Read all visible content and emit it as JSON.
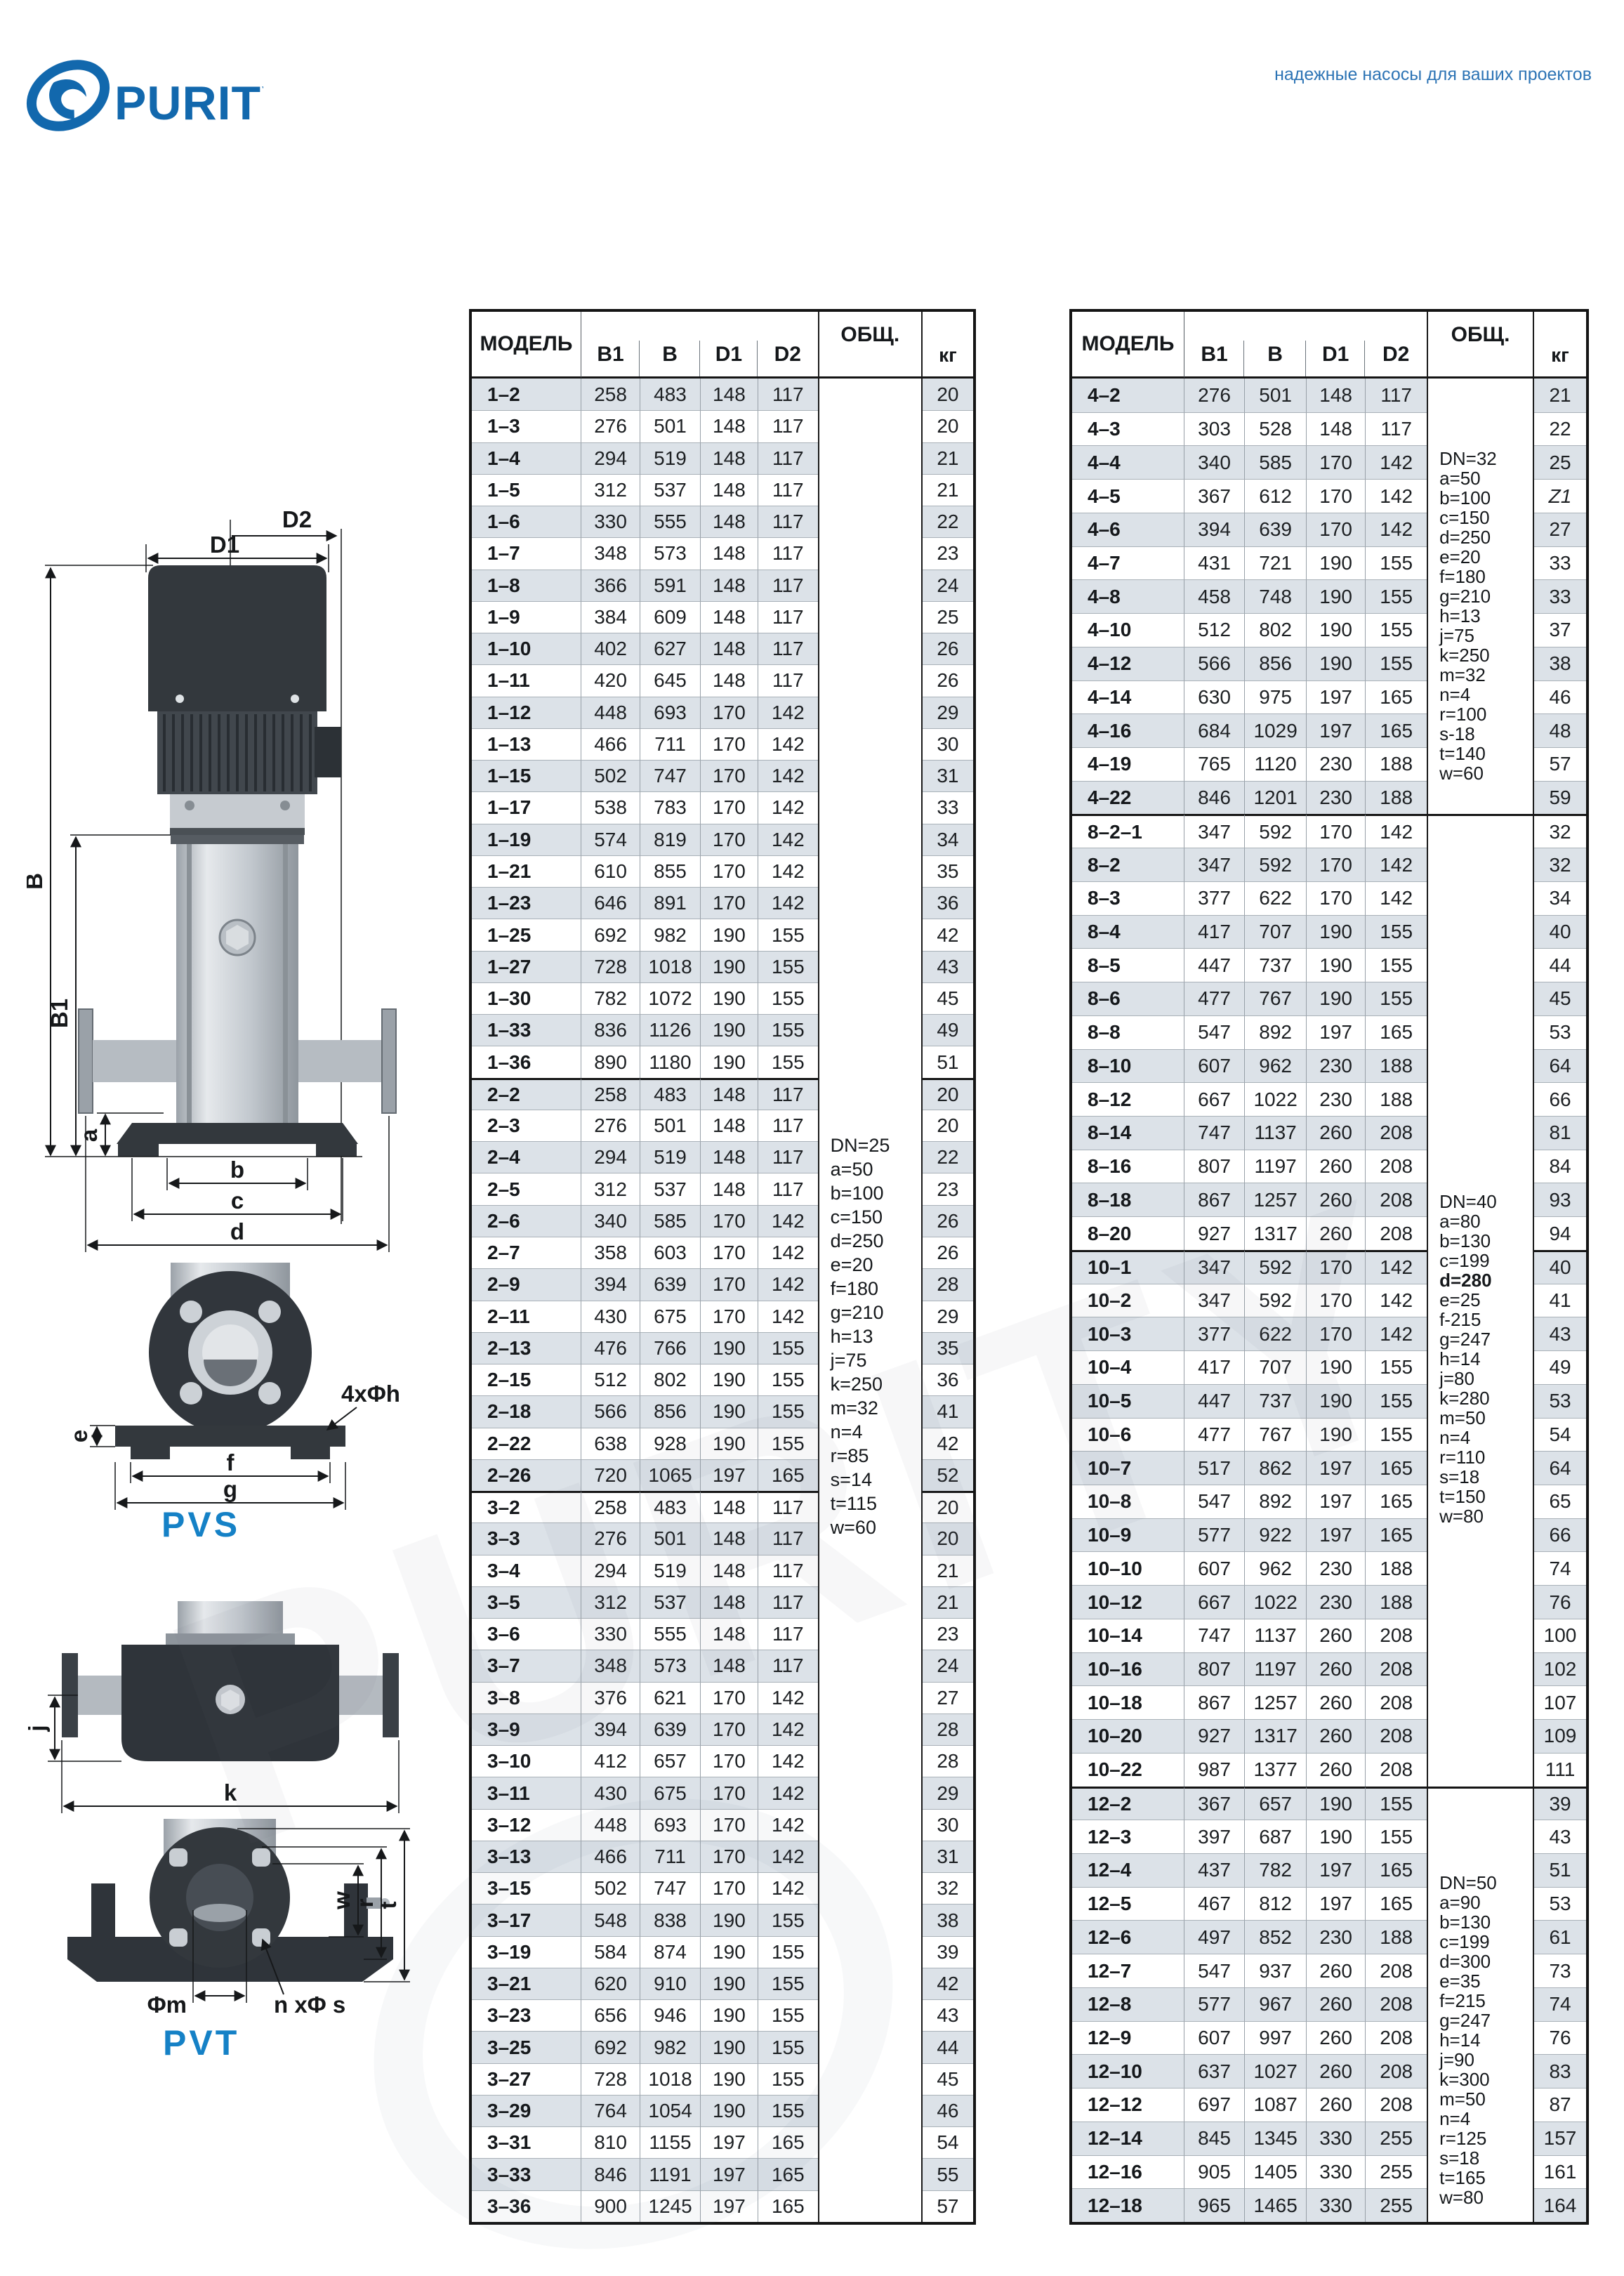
{
  "brand": {
    "wordmark": "PURITY",
    "tagline": "надежные насосы для ваших проектов",
    "accent": "#1268ad",
    "label_blue": "#1581c6",
    "stripe": "#dce2e8"
  },
  "drawings": {
    "pvs_label": "PVS",
    "pvt_label": "PVT",
    "side": {
      "d2": "D2",
      "d1": "D1",
      "b": "B",
      "b1": "B1",
      "a": "a",
      "dim_b": "b",
      "dim_c": "c",
      "dim_d": "d"
    },
    "front": {
      "holes": "4xΦh",
      "e": "e",
      "f": "f",
      "g": "g"
    },
    "inline": {
      "j": "j",
      "k": "k"
    },
    "section": {
      "w": "w",
      "r": "r",
      "t": "t",
      "phi_m": "Φm",
      "n_phi_s": "n xΦ s"
    }
  },
  "tables": {
    "headers": {
      "model": "МОДЕЛЬ",
      "cols": [
        "B1",
        "B",
        "D1",
        "D2"
      ],
      "notes": "ОБЩ.",
      "weight": "кг"
    },
    "left": {
      "groups": [
        {
          "rows": [
            [
              "1–2",
              258,
              483,
              148,
              117,
              20
            ],
            [
              "1–3",
              276,
              501,
              148,
              117,
              20
            ],
            [
              "1–4",
              294,
              519,
              148,
              117,
              21
            ],
            [
              "1–5",
              312,
              537,
              148,
              117,
              21
            ],
            [
              "1–6",
              330,
              555,
              148,
              117,
              22
            ],
            [
              "1–7",
              348,
              573,
              148,
              117,
              23
            ],
            [
              "1–8",
              366,
              591,
              148,
              117,
              24
            ],
            [
              "1–9",
              384,
              609,
              148,
              117,
              25
            ],
            [
              "1–10",
              402,
              627,
              148,
              117,
              26
            ],
            [
              "1–11",
              420,
              645,
              148,
              117,
              26
            ],
            [
              "1–12",
              448,
              693,
              170,
              142,
              29
            ],
            [
              "1–13",
              466,
              711,
              170,
              142,
              30
            ],
            [
              "1–15",
              502,
              747,
              170,
              142,
              31
            ],
            [
              "1–17",
              538,
              783,
              170,
              142,
              33
            ],
            [
              "1–19",
              574,
              819,
              170,
              142,
              34
            ],
            [
              "1–21",
              610,
              855,
              170,
              142,
              35
            ],
            [
              "1–23",
              646,
              891,
              170,
              142,
              36
            ],
            [
              "1–25",
              692,
              982,
              190,
              155,
              42
            ],
            [
              "1–27",
              728,
              1018,
              190,
              155,
              43
            ],
            [
              "1–30",
              782,
              1072,
              190,
              155,
              45
            ],
            [
              "1–33",
              836,
              1126,
              190,
              155,
              49
            ],
            [
              "1–36",
              890,
              1180,
              190,
              155,
              51
            ]
          ]
        },
        {
          "rows": [
            [
              "2–2",
              258,
              483,
              148,
              117,
              20
            ],
            [
              "2–3",
              276,
              501,
              148,
              117,
              20
            ],
            [
              "2–4",
              294,
              519,
              148,
              117,
              22
            ],
            [
              "2–5",
              312,
              537,
              148,
              117,
              23
            ],
            [
              "2–6",
              340,
              585,
              170,
              142,
              26
            ],
            [
              "2–7",
              358,
              603,
              170,
              142,
              26
            ],
            [
              "2–9",
              394,
              639,
              170,
              142,
              28
            ],
            [
              "2–11",
              430,
              675,
              170,
              142,
              29
            ],
            [
              "2–13",
              476,
              766,
              190,
              155,
              35
            ],
            [
              "2–15",
              512,
              802,
              190,
              155,
              36
            ],
            [
              "2–18",
              566,
              856,
              190,
              155,
              41
            ],
            [
              "2–22",
              638,
              928,
              190,
              155,
              42
            ],
            [
              "2–26",
              720,
              1065,
              197,
              165,
              52
            ]
          ]
        },
        {
          "rows": [
            [
              "3–2",
              258,
              483,
              148,
              117,
              20
            ],
            [
              "3–3",
              276,
              501,
              148,
              117,
              20
            ],
            [
              "3–4",
              294,
              519,
              148,
              117,
              21
            ],
            [
              "3–5",
              312,
              537,
              148,
              117,
              21
            ],
            [
              "3–6",
              330,
              555,
              148,
              117,
              23
            ],
            [
              "3–7",
              348,
              573,
              148,
              117,
              24
            ],
            [
              "3–8",
              376,
              621,
              170,
              142,
              27
            ],
            [
              "3–9",
              394,
              639,
              170,
              142,
              28
            ],
            [
              "3–10",
              412,
              657,
              170,
              142,
              28
            ],
            [
              "3–11",
              430,
              675,
              170,
              142,
              29
            ],
            [
              "3–12",
              448,
              693,
              170,
              142,
              30
            ],
            [
              "3–13",
              466,
              711,
              170,
              142,
              31
            ],
            [
              "3–15",
              502,
              747,
              170,
              142,
              32
            ],
            [
              "3–17",
              548,
              838,
              190,
              155,
              38
            ],
            [
              "3–19",
              584,
              874,
              190,
              155,
              39
            ],
            [
              "3–21",
              620,
              910,
              190,
              155,
              42
            ],
            [
              "3–23",
              656,
              946,
              190,
              155,
              43
            ],
            [
              "3–25",
              692,
              982,
              190,
              155,
              44
            ],
            [
              "3–27",
              728,
              1018,
              190,
              155,
              45
            ],
            [
              "3–29",
              764,
              1054,
              190,
              155,
              46
            ],
            [
              "3–31",
              810,
              1155,
              197,
              165,
              54
            ],
            [
              "3–33",
              846,
              1191,
              197,
              165,
              55
            ],
            [
              "3–36",
              900,
              1245,
              197,
              165,
              57
            ]
          ]
        }
      ],
      "notes": [
        {
          "start": 0,
          "span": 58,
          "cls": "noff-l",
          "bold": [],
          "lines": [
            "DN=25",
            "a=50",
            "b=100",
            "c=150",
            "d=250",
            "e=20",
            "f=180",
            "g=210",
            "h=13",
            "j=75",
            "k=250",
            "m=32",
            "n=4",
            "r=85",
            "s=14",
            "t=115",
            "w=60"
          ]
        }
      ]
    },
    "right": {
      "groups": [
        {
          "rows": [
            [
              "4–2",
              276,
              501,
              148,
              117,
              21
            ],
            [
              "4–3",
              303,
              528,
              148,
              117,
              22
            ],
            [
              "4–4",
              340,
              585,
              170,
              142,
              25
            ],
            [
              "4–5",
              367,
              612,
              170,
              142,
              "Z1"
            ],
            [
              "4–6",
              394,
              639,
              170,
              142,
              27
            ],
            [
              "4–7",
              431,
              721,
              190,
              155,
              33
            ],
            [
              "4–8",
              458,
              748,
              190,
              155,
              33
            ],
            [
              "4–10",
              512,
              802,
              190,
              155,
              37
            ],
            [
              "4–12",
              566,
              856,
              190,
              155,
              38
            ],
            [
              "4–14",
              630,
              975,
              197,
              165,
              46
            ],
            [
              "4–16",
              684,
              1029,
              197,
              165,
              48
            ],
            [
              "4–19",
              765,
              1120,
              230,
              188,
              57
            ],
            [
              "4–22",
              846,
              1201,
              230,
              188,
              59
            ]
          ]
        },
        {
          "rows": [
            [
              "8–2–1",
              347,
              592,
              170,
              142,
              32
            ],
            [
              "8–2",
              347,
              592,
              170,
              142,
              32
            ],
            [
              "8–3",
              377,
              622,
              170,
              142,
              34
            ],
            [
              "8–4",
              417,
              707,
              190,
              155,
              40
            ],
            [
              "8–5",
              447,
              737,
              190,
              155,
              44
            ],
            [
              "8–6",
              477,
              767,
              190,
              155,
              45
            ],
            [
              "8–8",
              547,
              892,
              197,
              165,
              53
            ],
            [
              "8–10",
              607,
              962,
              230,
              188,
              64
            ],
            [
              "8–12",
              667,
              1022,
              230,
              188,
              66
            ],
            [
              "8–14",
              747,
              1137,
              260,
              208,
              81
            ],
            [
              "8–16",
              807,
              1197,
              260,
              208,
              84
            ],
            [
              "8–18",
              867,
              1257,
              260,
              208,
              93
            ],
            [
              "8–20",
              927,
              1317,
              260,
              208,
              94
            ]
          ]
        },
        {
          "rows": [
            [
              "10–1",
              347,
              592,
              170,
              142,
              40
            ],
            [
              "10–2",
              347,
              592,
              170,
              142,
              41
            ],
            [
              "10–3",
              377,
              622,
              170,
              142,
              43
            ],
            [
              "10–4",
              417,
              707,
              190,
              155,
              49
            ],
            [
              "10–5",
              447,
              737,
              190,
              155,
              53
            ],
            [
              "10–6",
              477,
              767,
              190,
              155,
              54
            ],
            [
              "10–7",
              517,
              862,
              197,
              165,
              64
            ],
            [
              "10–8",
              547,
              892,
              197,
              165,
              65
            ],
            [
              "10–9",
              577,
              922,
              197,
              165,
              66
            ],
            [
              "10–10",
              607,
              962,
              230,
              188,
              74
            ],
            [
              "10–12",
              667,
              1022,
              230,
              188,
              76
            ],
            [
              "10–14",
              747,
              1137,
              260,
              208,
              100
            ],
            [
              "10–16",
              807,
              1197,
              260,
              208,
              102
            ],
            [
              "10–18",
              867,
              1257,
              260,
              208,
              107
            ],
            [
              "10–20",
              927,
              1317,
              260,
              208,
              109
            ],
            [
              "10–22",
              987,
              1377,
              260,
              208,
              111
            ]
          ]
        },
        {
          "rows": [
            [
              "12–2",
              367,
              657,
              190,
              155,
              39
            ],
            [
              "12–3",
              397,
              687,
              190,
              155,
              43
            ],
            [
              "12–4",
              437,
              782,
              197,
              165,
              51
            ],
            [
              "12–5",
              467,
              812,
              197,
              165,
              53
            ],
            [
              "12–6",
              497,
              852,
              230,
              188,
              61
            ],
            [
              "12–7",
              547,
              937,
              260,
              208,
              73
            ],
            [
              "12–8",
              577,
              967,
              260,
              208,
              74
            ],
            [
              "12–9",
              607,
              997,
              260,
              208,
              76
            ],
            [
              "12–10",
              637,
              1027,
              260,
              208,
              83
            ],
            [
              "12–12",
              697,
              1087,
              260,
              208,
              87
            ],
            [
              "12–14",
              845,
              1345,
              330,
              255,
              157
            ],
            [
              "12–16",
              905,
              1405,
              330,
              255,
              161
            ],
            [
              "12–18",
              965,
              1465,
              330,
              255,
              164
            ]
          ]
        }
      ],
      "notes": [
        {
          "start": 0,
          "span": 13,
          "cls": "noff-a",
          "bold": [],
          "lines": [
            "DN=32",
            "a=50",
            "b=100",
            "c=150",
            "d=250",
            "e=20",
            "f=180",
            "g=210",
            "h=13",
            "j=75",
            "k=250",
            "m=32",
            "n=4",
            "r=100",
            "s-18",
            "t=140",
            "w=60"
          ]
        },
        {
          "start": 13,
          "span": 29,
          "cls": "noff-b",
          "bold": [
            "d=280"
          ],
          "lines": [
            "DN=40",
            "a=80",
            "b=130",
            "c=199",
            "d=280",
            "e=25",
            "f-215",
            "g=247",
            "h=14",
            "j=80",
            "k=280",
            "m=50",
            "n=4",
            "r=110",
            "s=18",
            "t=150",
            "w=80"
          ]
        },
        {
          "start": 42,
          "span": 13,
          "cls": "noff-c",
          "bold": [],
          "lines": [
            "DN=50",
            "a=90",
            "b=130",
            "c=199",
            "d=300",
            "e=35",
            "f=215",
            "g=247",
            "h=14",
            "j=90",
            "k=300",
            "m=50",
            "n=4",
            "r=125",
            "s=18",
            "t=165",
            "w=80"
          ]
        }
      ]
    }
  }
}
